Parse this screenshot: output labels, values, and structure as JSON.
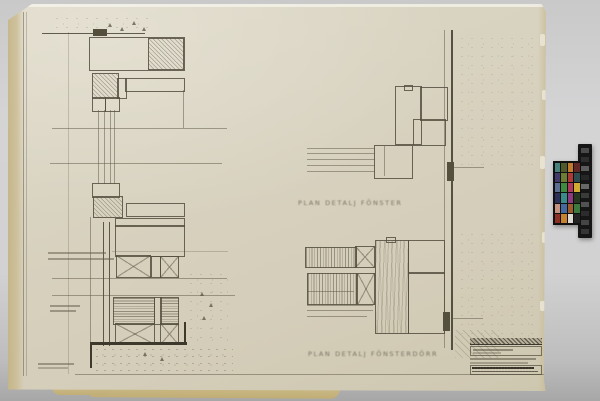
{
  "captions": {
    "upper_detail": "PLAN DETALJ FÖNSTER",
    "lower_detail": "PLAN DETALJ FÖNSTERDÖRR"
  },
  "palette": {
    "background_gray": "#d2d2d3",
    "paper_cream": "#d7d1be",
    "paper_edge_tan": "#c8ba8c",
    "pencil_ink": "#544f3f",
    "pencil_dark": "#3d392d"
  },
  "color_checker": {
    "frame": "#141414",
    "patches": [
      "#48807b",
      "#4f5a2b",
      "#c27a2e",
      "#5f2726",
      "#423a6a",
      "#6d7c33",
      "#ad3a38",
      "#2c4c50",
      "#5d6d92",
      "#3f8a41",
      "#b03a5e",
      "#d0ac32",
      "#2c3058",
      "#3b8a8a",
      "#8f3a80",
      "#273621",
      "#c4927f",
      "#44689f",
      "#9e5c2c",
      "#3d7a3d",
      "#8c3026",
      "#c8812e",
      "#dcdad2",
      "#242424"
    ],
    "strip": [
      "#4a4a4a",
      "#2e2e2e",
      "#5c5c5c",
      "#272727",
      "#676767",
      "#3a3a3a",
      "#525252",
      "#2c2c2c",
      "#454545",
      "#363636"
    ]
  }
}
